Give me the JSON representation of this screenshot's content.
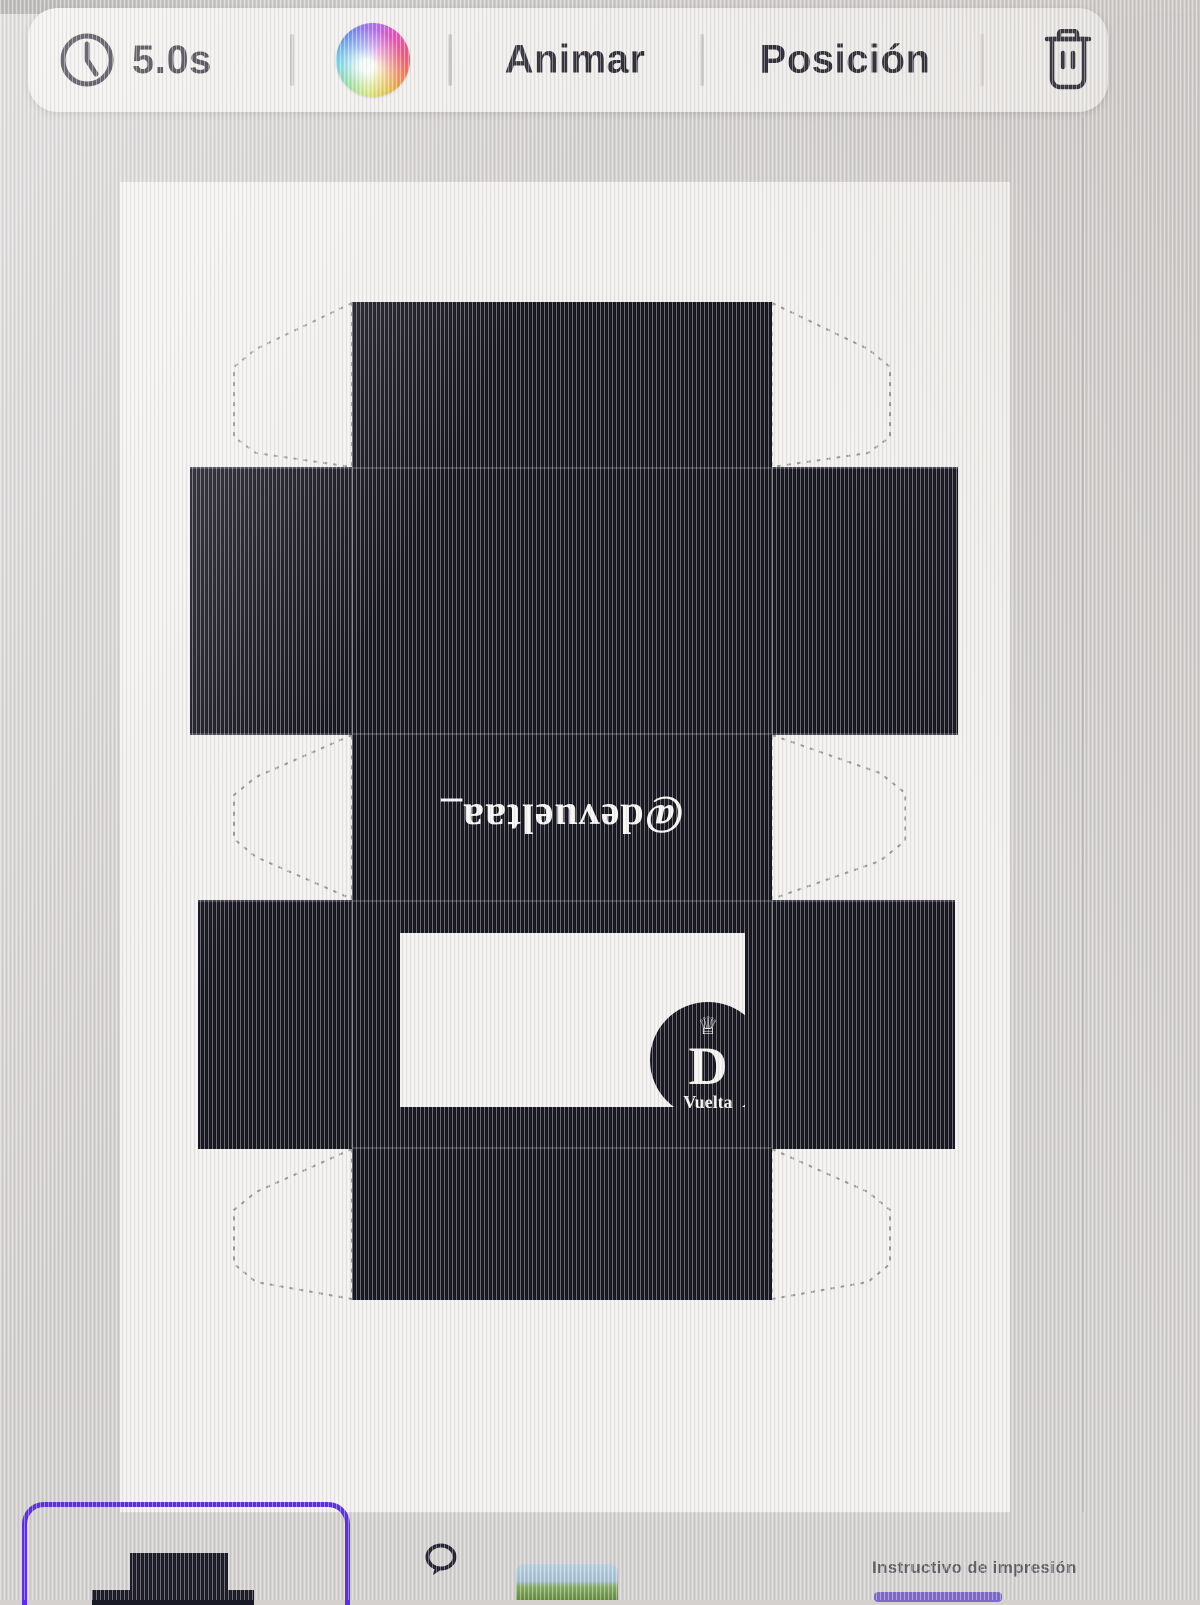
{
  "toolbar": {
    "duration": {
      "label": "5.0s",
      "icon": "clock-icon"
    },
    "color_wheel_icon": "color-wheel-icon",
    "animate_label": "Animar",
    "position_label": "Posición",
    "delete_icon": "trash-icon"
  },
  "canvas": {
    "dieline": {
      "handle_text": "@devueltaa_",
      "handle_rotation_deg": 180,
      "logo": {
        "crown": "♕",
        "initial": "D",
        "name": "Vuelta"
      }
    }
  },
  "footer": {
    "caption": "Instructivo de impresión",
    "comment_icon": "speech-bubble-icon"
  },
  "colors": {
    "panel_black": "#15141f",
    "toolbar_text": "#2d2c36",
    "accent_purple": "#5d2de6",
    "canvas_bg": "#f2f0ed"
  }
}
